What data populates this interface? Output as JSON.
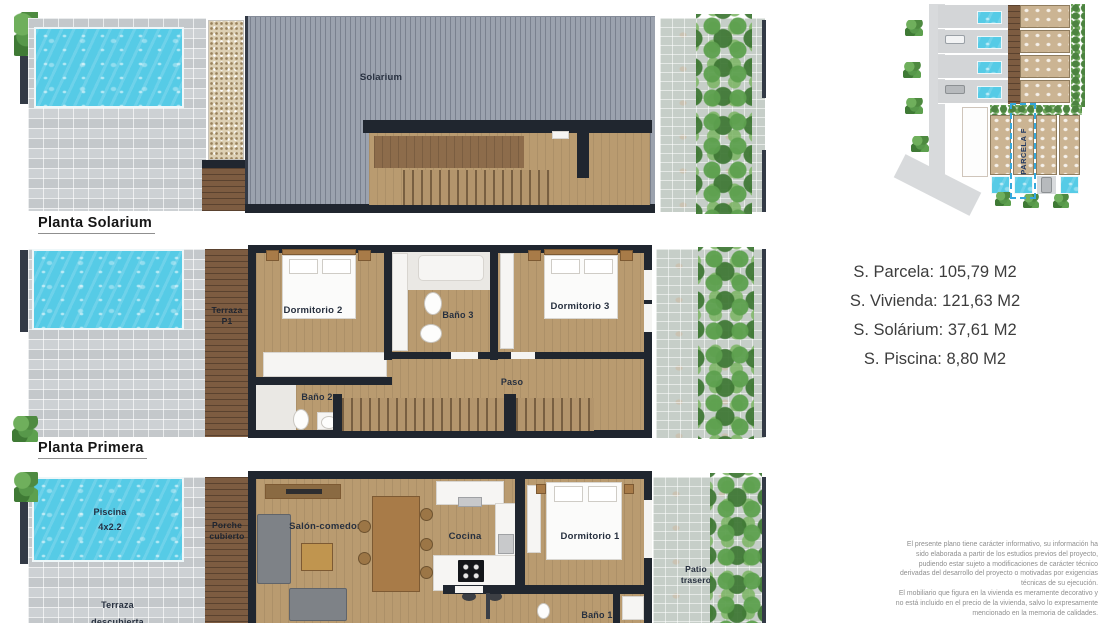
{
  "floors": [
    {
      "label": "Planta Solarium",
      "rooms": {
        "solarium": "Solarium"
      }
    },
    {
      "label": "Planta Primera",
      "rooms": {
        "terraza_line1": "Terraza",
        "terraza_line2": "P1",
        "dormitorio2": "Dormitorio 2",
        "bano2": "Baño 2",
        "bano3": "Baño 3",
        "dormitorio3": "Dormitorio 3",
        "paso": "Paso"
      }
    },
    {
      "rooms": {
        "piscina_line1": "Piscina",
        "piscina_line2": "4x2.2",
        "terraza_line1": "Terraza",
        "terraza_line2": "descubierta",
        "porche_line1": "Porche",
        "porche_line2": "cubierto",
        "salon": "Salón-comedor",
        "cocina": "Cocina",
        "dormitorio1": "Dormitorio 1",
        "bano1": "Baño 1",
        "patio_line1": "Patio",
        "patio_line2": "trasero"
      }
    }
  ],
  "siteplan": {
    "parcel_label": "PARCELA F"
  },
  "areas": {
    "lines": [
      "S. Parcela: 105,79 M2",
      "S. Vivienda: 121,63 M2",
      "S. Solárium: 37,61 M2",
      "S. Piscina: 8,80 M2"
    ]
  },
  "disclaimer": {
    "lines": [
      "El presente plano tiene carácter informativo, su información ha",
      "sido elaborada a partir de los estudios previos del proyecto,",
      "pudiendo estar sujeto a modificaciones de carácter técnico",
      "derivadas del desarrollo del proyecto o motivadas por exigencias",
      "técnicas de su ejecución.",
      "El mobiliario que figura en la vivienda es meramente decorativo y",
      "no está incluido en el precio de la vivienda, salvo lo expresamente",
      "mencionado en la memoria de calidades."
    ]
  },
  "colors": {
    "pool": "#56cbe6",
    "wall": "#20262f",
    "wood": "#b99b70",
    "parcel_outline": "#35a8dc"
  }
}
